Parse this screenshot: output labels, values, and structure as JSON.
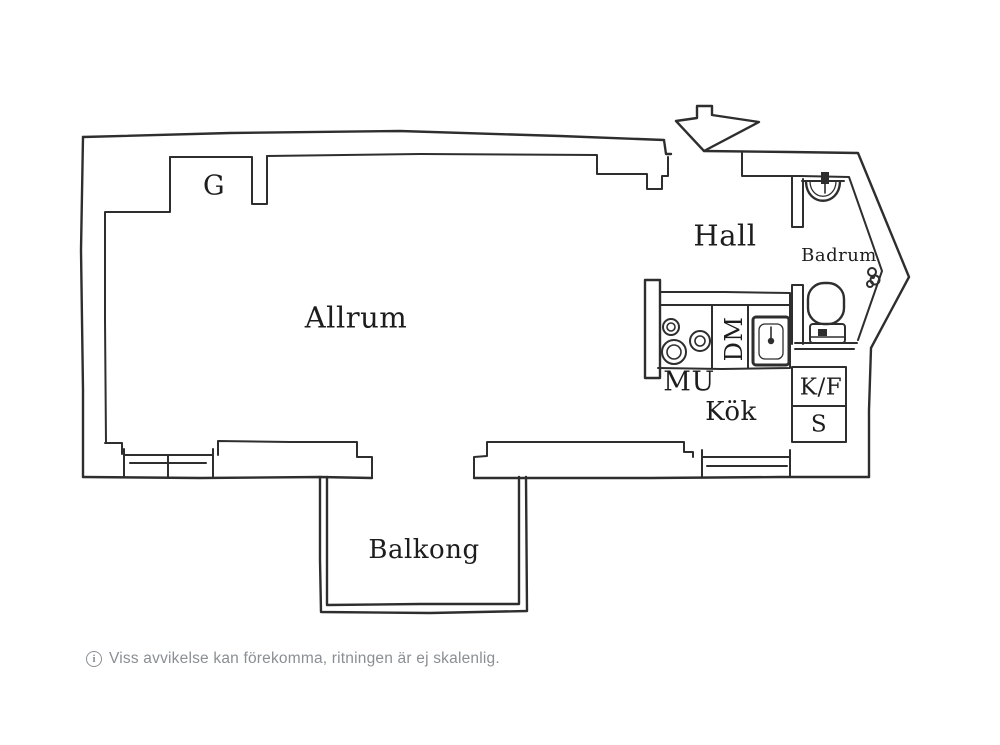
{
  "plan": {
    "labels": {
      "g": "G",
      "allrum": "Allrum",
      "hall": "Hall",
      "badrum": "Badrum",
      "mu": "MU",
      "dm": "DM",
      "kok": "Kök",
      "kf": "K/F",
      "s": "S",
      "balkong": "Balkong"
    }
  },
  "footer": {
    "info_glyph": "i",
    "text": "Viss avvikelse kan förekomma, ritningen är ej skalenlig."
  },
  "colors": {
    "wall": "#2e2e2e",
    "label": "#1d1d1d",
    "background": "#ffffff",
    "footer": "#8a8f94"
  }
}
